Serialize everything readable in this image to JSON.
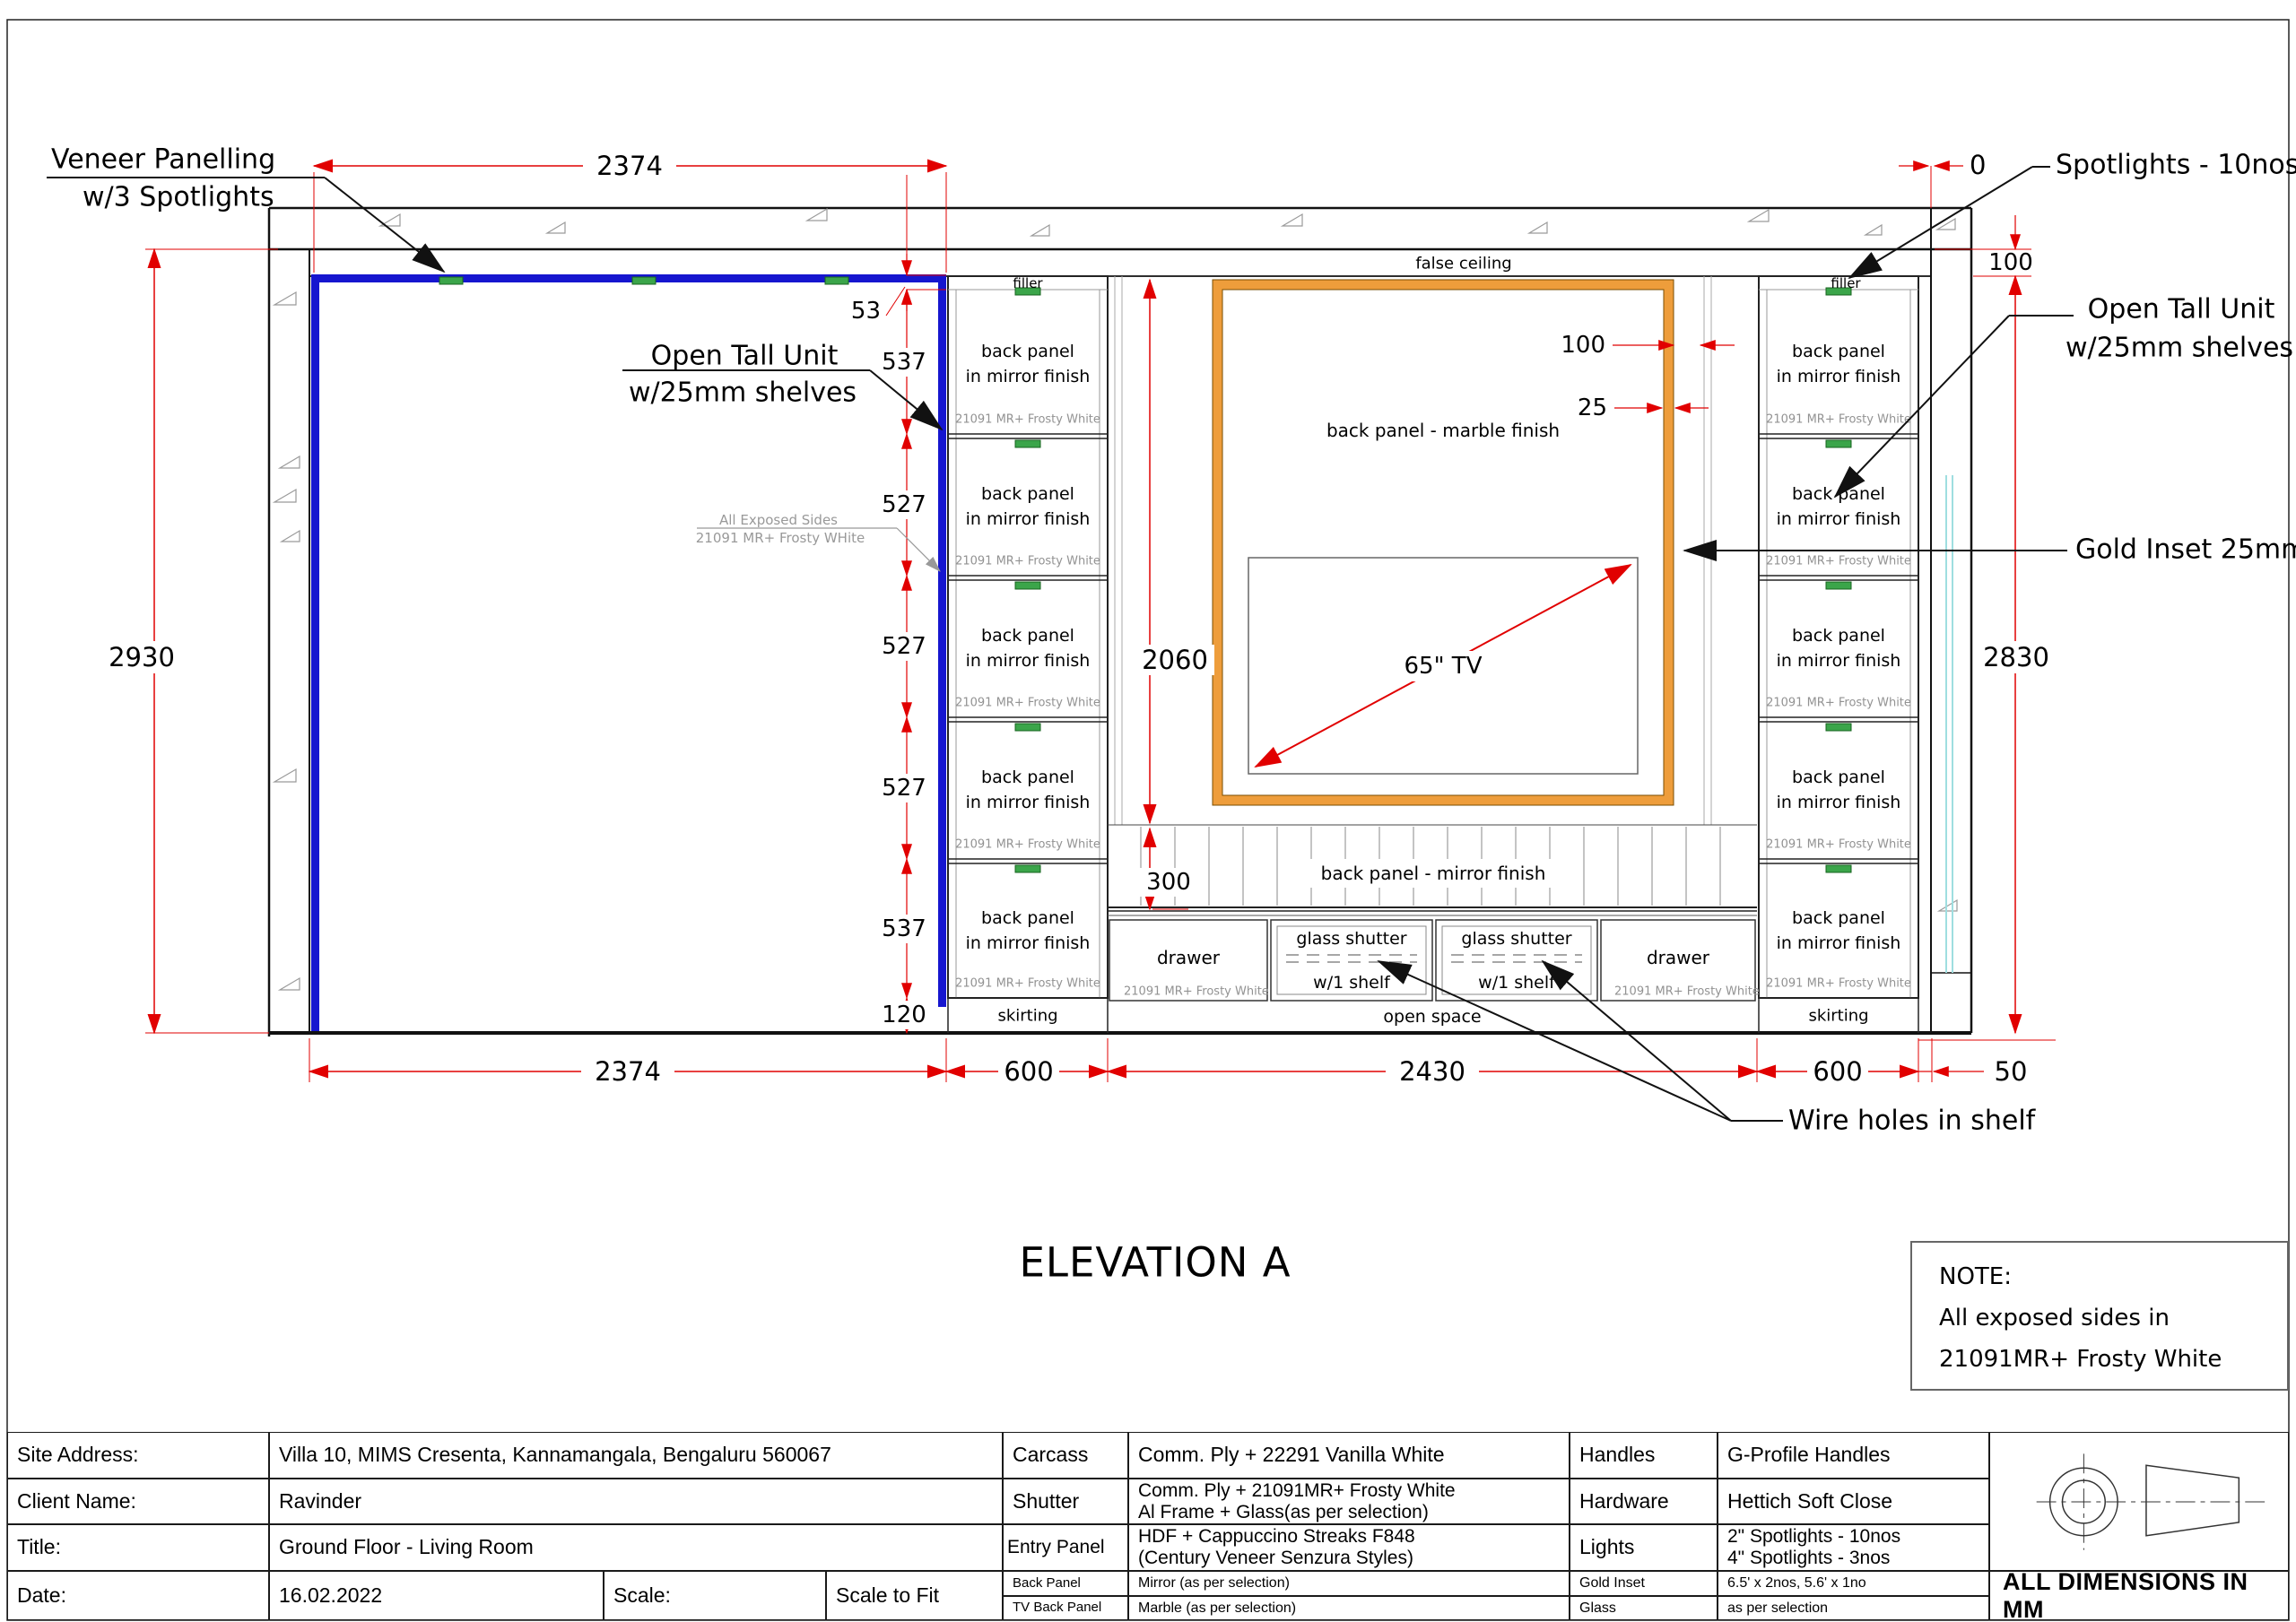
{
  "title": "ELEVATION A",
  "note": {
    "heading": "NOTE:",
    "line1": "All exposed sides in",
    "line2": "21091MR+ Frosty White"
  },
  "labels": {
    "false_ceiling": "false ceiling",
    "veneer1": "Veneer Panelling",
    "veneer2": "w/3 Spotlights",
    "spotlights": "Spotlights - 10nos",
    "open_tall_1": "Open Tall Unit",
    "open_tall_2": "w/25mm shelves",
    "gold_inset": "Gold Inset 25mm",
    "exposed1": "All Exposed Sides",
    "exposed2": "21091 MR+ Frosty WHite",
    "wire_holes": "Wire holes in shelf"
  },
  "dims": {
    "top_width": "2374",
    "left_total": "2930",
    "left_stack": [
      "53",
      "537",
      "527",
      "527",
      "527",
      "537",
      "120"
    ],
    "mid_height": "2060",
    "mirror_band": "300",
    "gold_gap": "100",
    "gold_width": "25",
    "right_gap": "100",
    "right_total": "2830",
    "zero": "0",
    "bottom": [
      "2374",
      "600",
      "2430",
      "600",
      "50"
    ]
  },
  "units": {
    "filler": "filler",
    "panel_line1": "back panel",
    "panel_line2": "in mirror finish",
    "finish": "21091 MR+ Frosty White",
    "skirting": "skirting"
  },
  "mid": {
    "marble": "back panel - marble finish",
    "tv": "65\" TV",
    "mirror": "back panel - mirror finish",
    "drawer": "drawer",
    "glass_shutter": "glass shutter",
    "one_shelf": "w/1 shelf",
    "open_space": "open space",
    "finish": "21091 MR+ Frosty White"
  },
  "colors": {
    "veneer_blue": "#1616CF",
    "gold_orange": "#EE9D3B",
    "dimension_red": "#E10000",
    "spotlight_green": "#3BA54A",
    "glass_cyan": "#9FDEE0"
  },
  "titleblock": {
    "site_label": "Site Address:",
    "site": "Villa 10, MIMS Cresenta, Kannamangala, Bengaluru 560067",
    "client_label": "Client Name:",
    "client": "Ravinder",
    "title_label": "Title:",
    "title": "Ground Floor - Living Room",
    "date_label": "Date:",
    "date": "16.02.2022",
    "scale_label": "Scale:",
    "scale": "Scale to Fit",
    "carcass_label": "Carcass",
    "carcass": "Comm. Ply + 22291 Vanilla White",
    "shutter_label": "Shutter",
    "shutter": "Comm. Ply + 21091MR+ Frosty White\nAl Frame + Glass(as per selection)",
    "entry_label": "Entry Panel",
    "entry": "HDF + Cappuccino Streaks F848\n(Century Veneer Senzura Styles)",
    "back_label": "Back Panel",
    "back": "Mirror (as per selection)",
    "tvback_label": "TV Back Panel",
    "tvback": "Marble (as per selection)",
    "handles_label": "Handles",
    "handles": "G-Profile Handles",
    "hardware_label": "Hardware",
    "hardware": "Hettich Soft Close",
    "lights_label": "Lights",
    "lights": "2\" Spotlights - 10nos\n4\" Spotlights - 3nos",
    "goldinset_label": "Gold Inset",
    "goldinset": "6.5' x 2nos, 5.6' x 1no",
    "glass_label": "Glass",
    "glass": "as per selection",
    "alldims": "ALL DIMENSIONS IN MM"
  }
}
